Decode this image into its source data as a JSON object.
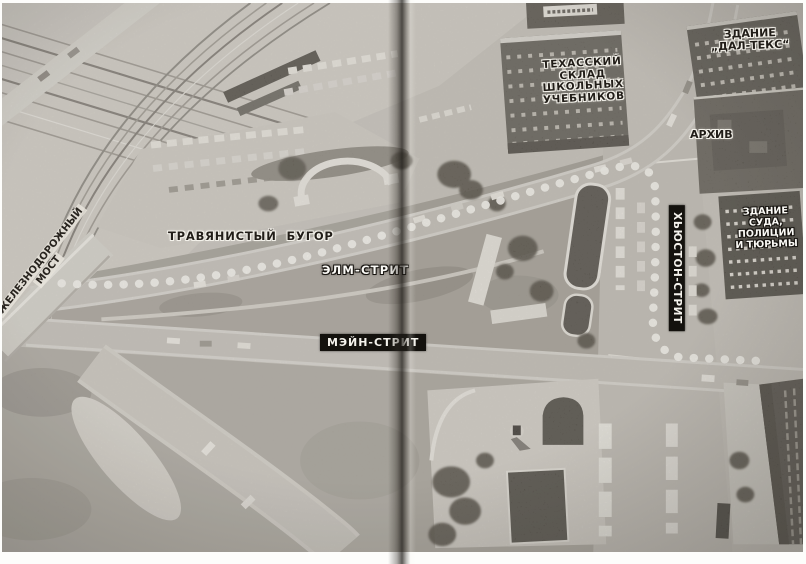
{
  "labels": {
    "depository": [
      "ТЕХАССКИЙ",
      "СКЛАД",
      "ШКОЛЬНЫХ",
      "УЧЕБНИКОВ"
    ],
    "dal_tex": [
      "ЗДАНИЕ",
      "„ДАЛ-ТЕКС“"
    ],
    "archive": "АРХИВ",
    "courts": [
      "ЗДАНИЕ",
      "СУДА,",
      "ПОЛИЦИИ",
      "И ТЮРЬМЫ"
    ],
    "railroad_bridge": [
      "ЖЕЛЕЗНОДОРОЖНЫЙ",
      "МОСТ"
    ],
    "grassy_knoll": "ТРАВЯНИСТЫЙ БУГОР",
    "elm_street": "ЭЛМ-СТРИТ",
    "main_street": "МЭЙН-СТРИТ",
    "houston_street": "ХЬЮСТОН-СТРИТ"
  },
  "route": {
    "marker": "white-dot-path",
    "color": "#f7f5f0"
  },
  "colors": {
    "photo_base": "#c2beb6",
    "building_dark": "#4e4a43",
    "label_box_bg": "#14120e"
  }
}
